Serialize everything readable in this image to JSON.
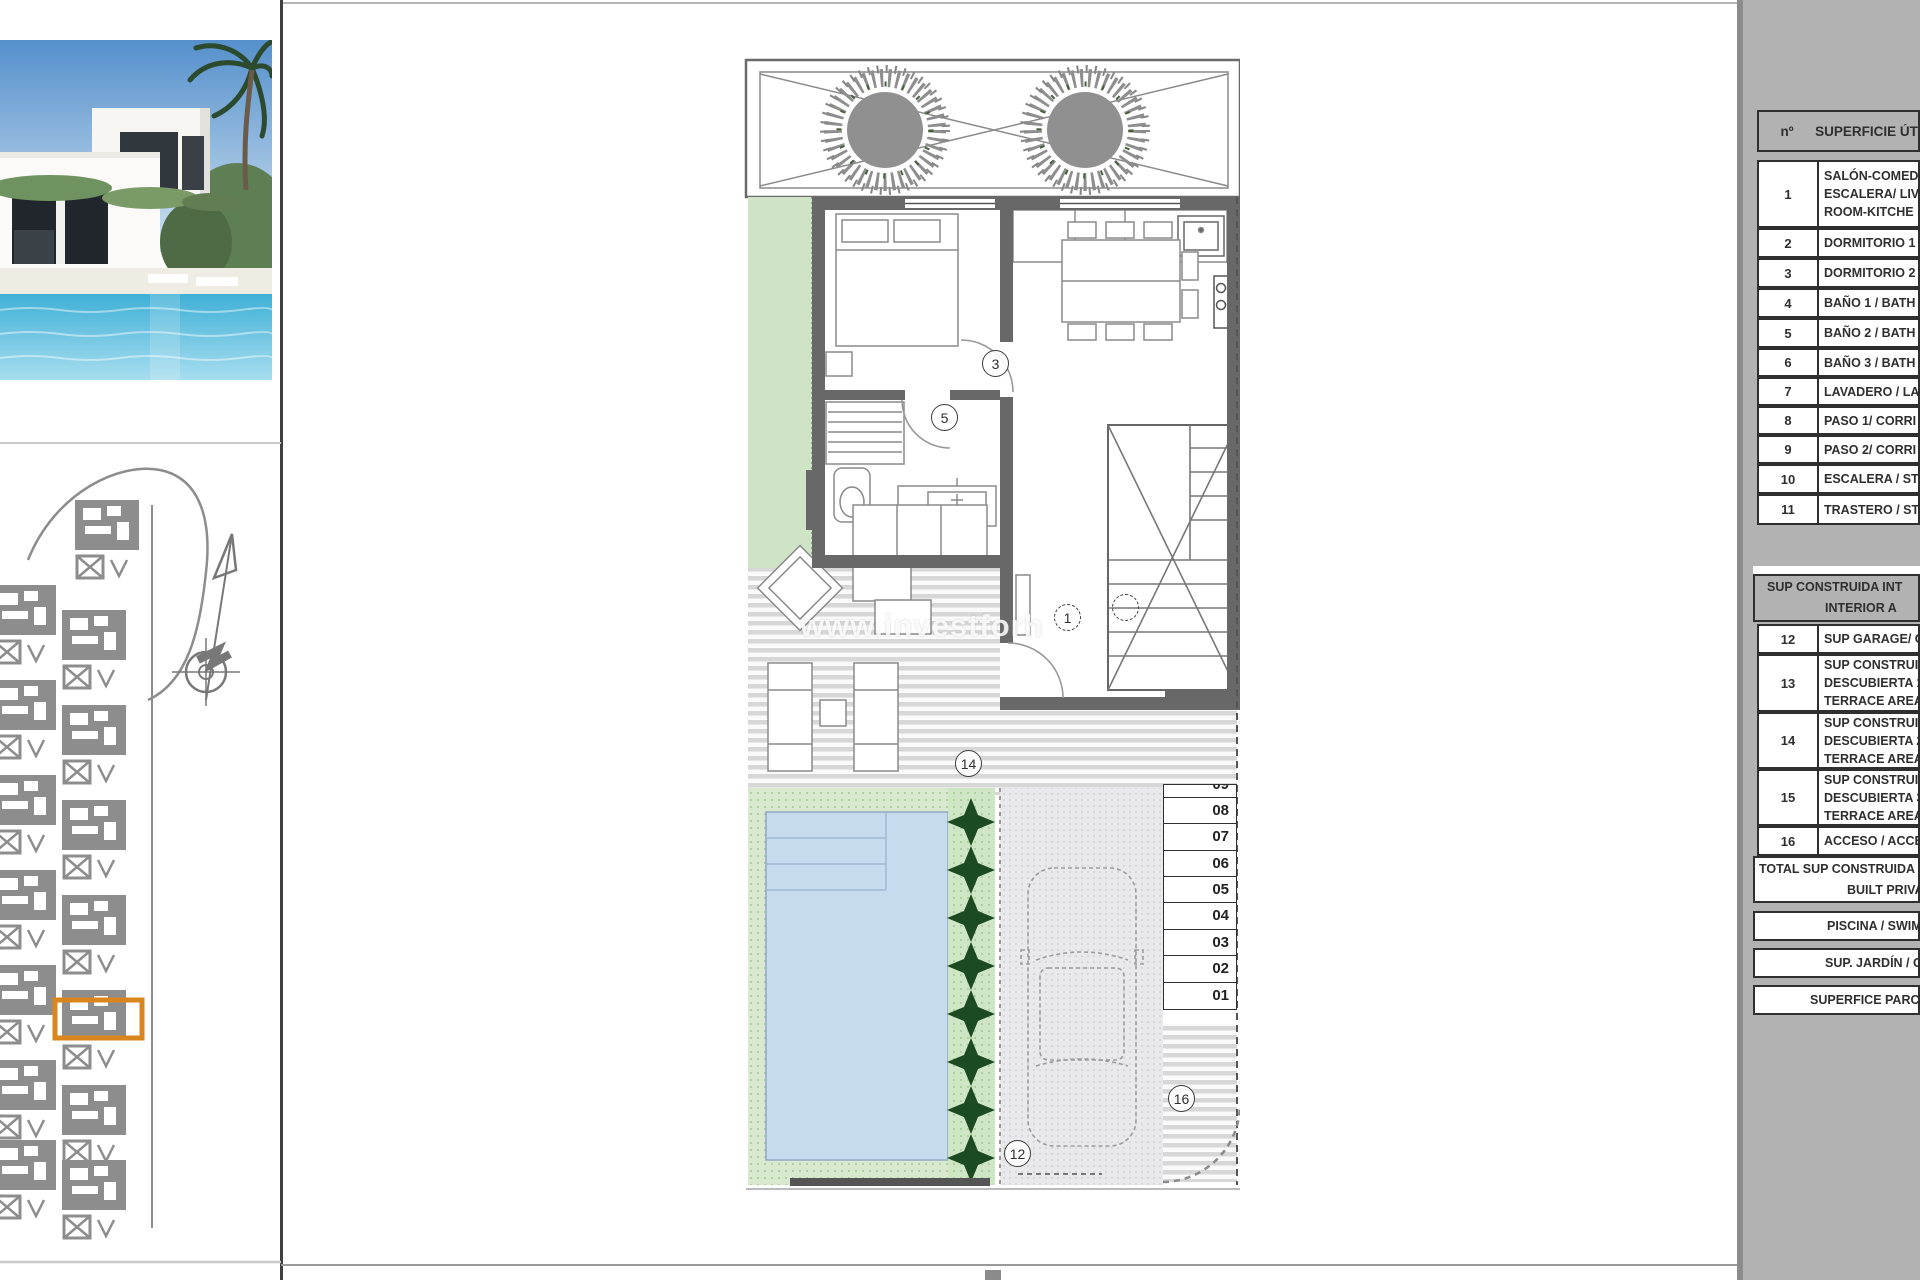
{
  "watermark": "www.investforh",
  "table": {
    "header": {
      "num": "nº",
      "label": "SUPERFICIE ÚTI"
    },
    "rows1": [
      {
        "num": "1",
        "lines": [
          "SALÓN-COMED",
          "ESCALERA/ LIVI",
          "ROOM-KITCHE"
        ]
      },
      {
        "num": "2",
        "lines": [
          "DORMITORIO 1"
        ]
      },
      {
        "num": "3",
        "lines": [
          "DORMITORIO 2"
        ]
      },
      {
        "num": "4",
        "lines": [
          "BAÑO 1 / BATH"
        ]
      },
      {
        "num": "5",
        "lines": [
          "BAÑO 2 / BATH"
        ]
      },
      {
        "num": "6",
        "lines": [
          "BAÑO 3 / BATH"
        ]
      },
      {
        "num": "7",
        "lines": [
          "LAVADERO / LA"
        ]
      },
      {
        "num": "8",
        "lines": [
          "PASO 1/ CORRI"
        ]
      },
      {
        "num": "9",
        "lines": [
          "PASO 2/ CORRI"
        ]
      },
      {
        "num": "10",
        "lines": [
          "ESCALERA / STA"
        ]
      },
      {
        "num": "11",
        "lines": [
          "TRASTERO / STO"
        ]
      }
    ],
    "section2_header": {
      "l1": "SUP CONSTRUIDA INT",
      "l2": "INTERIOR A"
    },
    "rows2": [
      {
        "num": "12",
        "lines": [
          "SUP GARAGE/ G"
        ]
      },
      {
        "num": "13",
        "lines": [
          "SUP CONSTRUI",
          "DESCUBIERTA 1",
          "TERRACE AREA"
        ]
      },
      {
        "num": "14",
        "lines": [
          "SUP CONSTRUI",
          "DESCUBIERTA 2",
          "TERRACE AREA"
        ]
      },
      {
        "num": "15",
        "lines": [
          "SUP CONSTRUI",
          "DESCUBIERTA 3",
          "TERRACE AREA"
        ]
      },
      {
        "num": "16",
        "lines": [
          "ACCESO / ACCE"
        ]
      }
    ],
    "total": {
      "l1": "TOTAL SUP CONSTRUIDA",
      "l2": "BUILT PRIVAT"
    },
    "summary": [
      "PISCINA / SWIMM",
      "SUP. JARDÍN / GAR",
      "SUPERFICE PARCELA"
    ]
  },
  "plan": {
    "circles": {
      "bedroom_door": "3",
      "bathroom_door": "5",
      "living": "1",
      "terrace": "14",
      "garage": "12",
      "access": "16"
    },
    "stalls": [
      "09",
      "08",
      "07",
      "06",
      "05",
      "04",
      "03",
      "02",
      "01"
    ]
  },
  "colors": {
    "highlight_orange": "#D9861F",
    "pool_blue": "#C7DBEE",
    "garden_green": "#CFE4C6",
    "plant_dark_green": "#1C4A21",
    "panel_gray": "#B2B2B2",
    "wall_gray": "#686868",
    "siteplan_gray": "#8D8D8D"
  }
}
